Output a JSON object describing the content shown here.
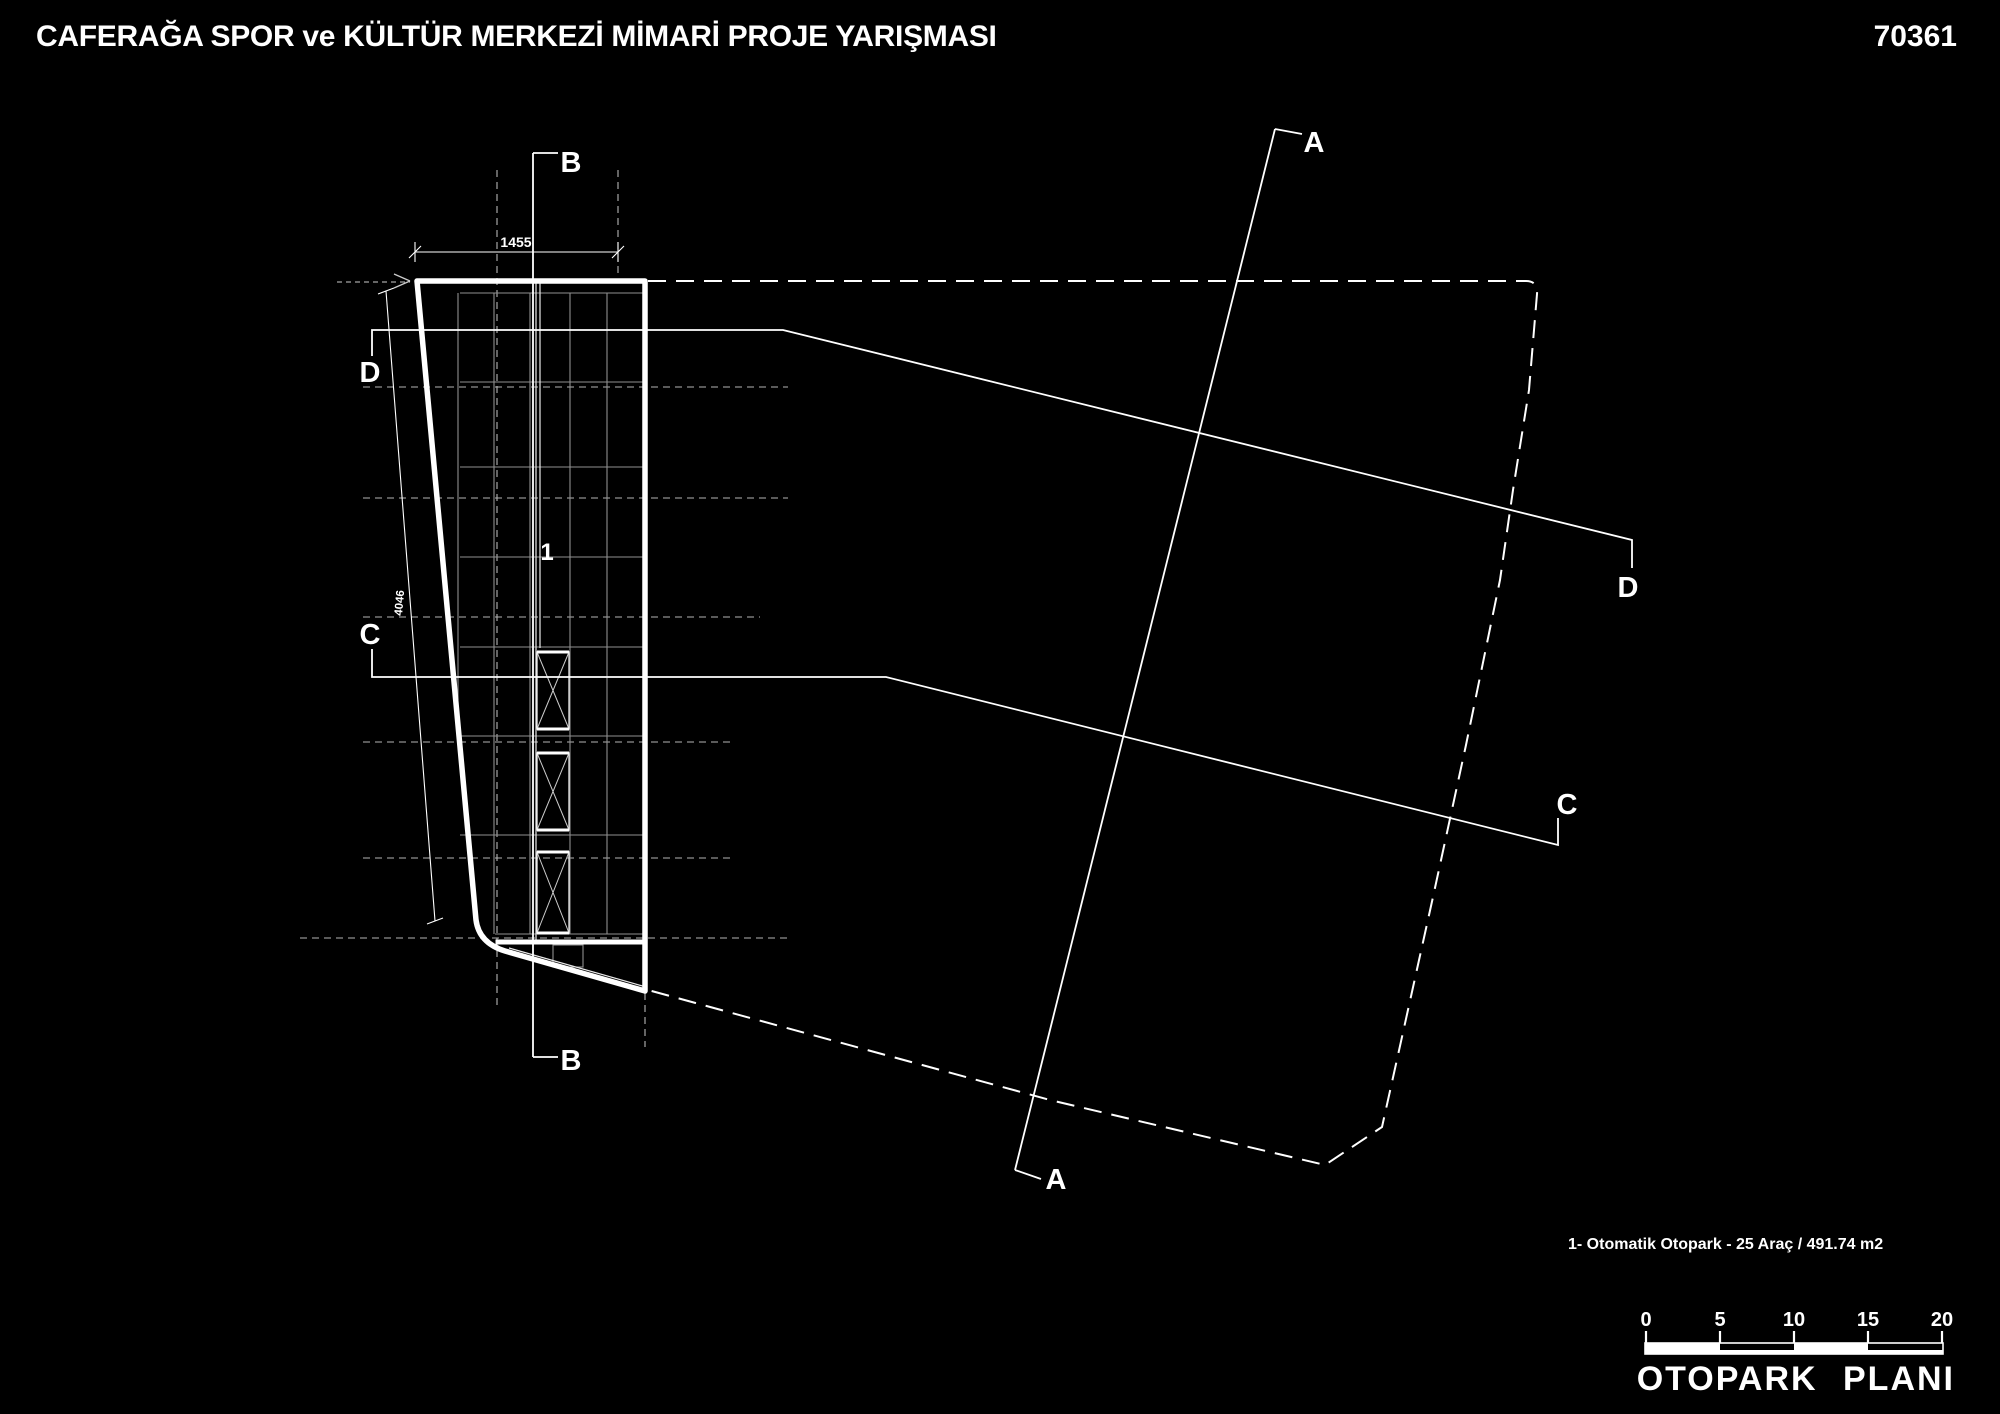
{
  "header": {
    "title": "CAFERAĞA SPOR ve KÜLTÜR MERKEZİ MİMARİ PROJE YARIŞMASI",
    "entry_code": "70361"
  },
  "plan": {
    "caption": "OTOPARK PLANI",
    "note": "1- Otomatik Otopark - 25 Araç / 491.74 m2",
    "room_number": "1",
    "sections": {
      "a": "A",
      "b": "B",
      "c": "C",
      "d": "D"
    },
    "dimensions": {
      "top_width": "1455",
      "left_height": "4046"
    },
    "scale_bar": {
      "ticks": [
        "0",
        "5",
        "10",
        "15",
        "20"
      ]
    },
    "colors": {
      "background": "#000000",
      "ink": "#ffffff",
      "grid": "#8f8f8f"
    }
  }
}
